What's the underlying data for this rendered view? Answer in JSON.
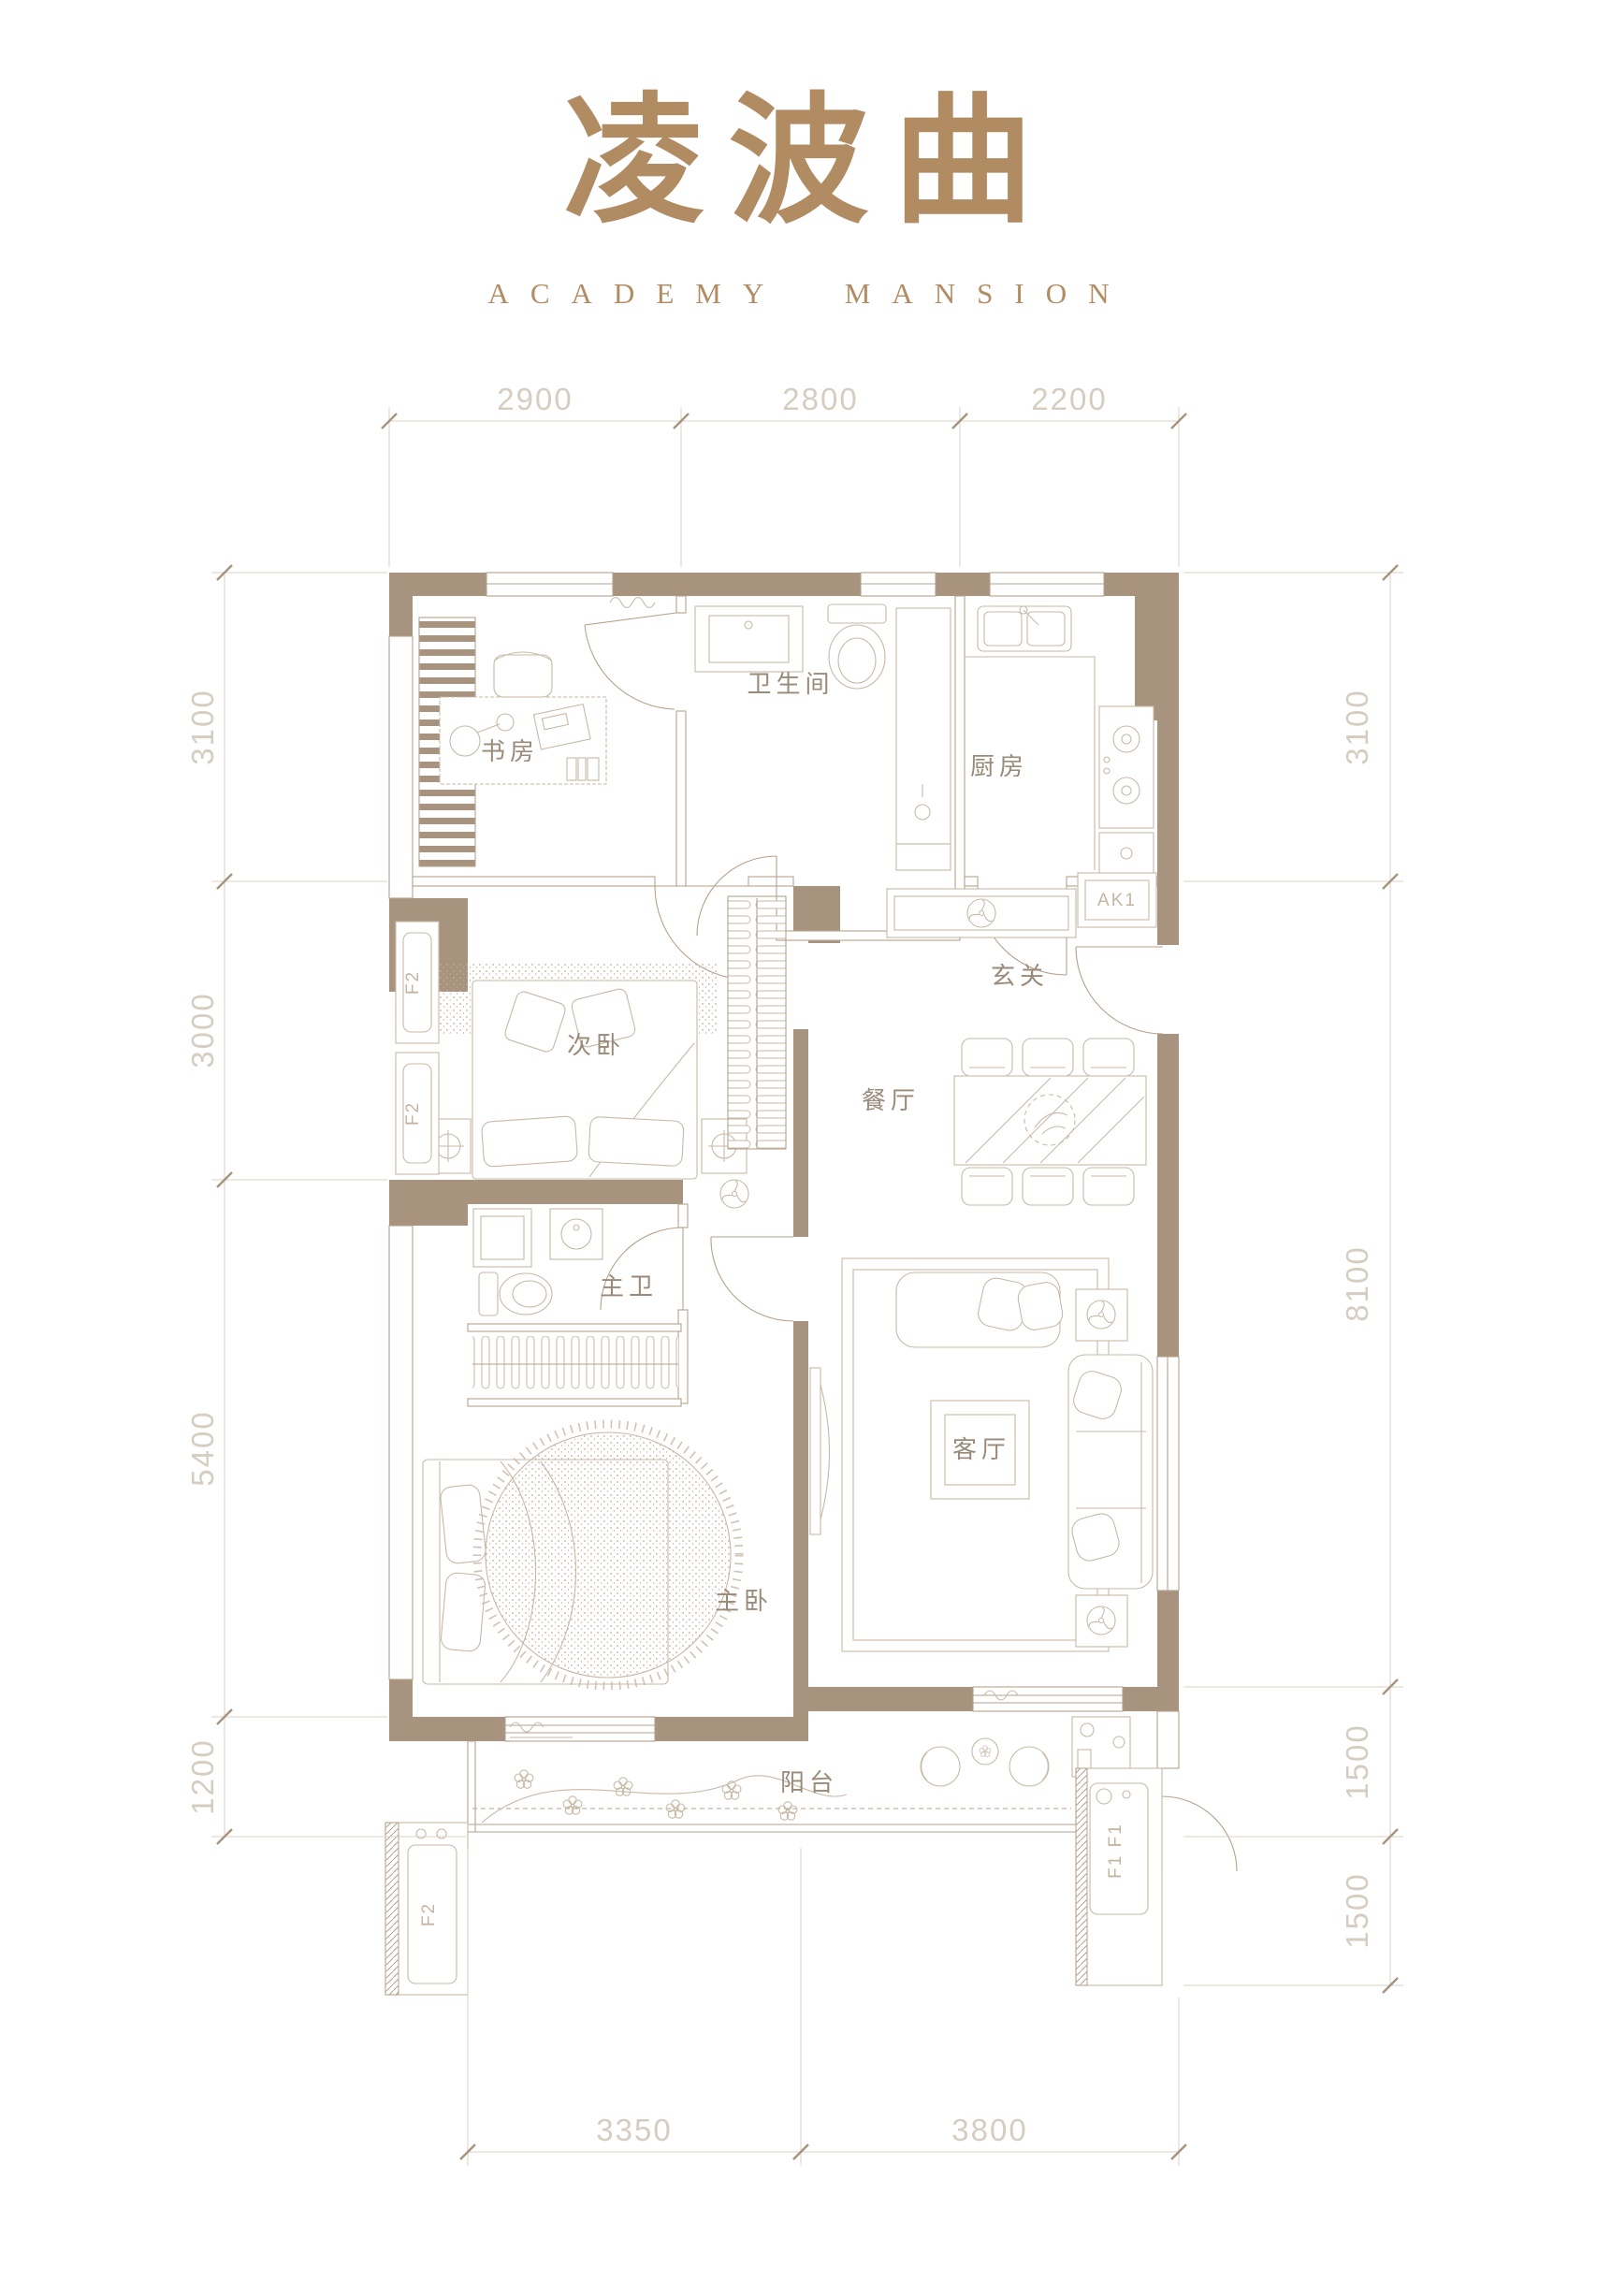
{
  "header": {
    "title": "凌波曲",
    "subtitle": "ACADEMY MANSION"
  },
  "colors": {
    "accent": "#b18c63",
    "wall": "#a8947e",
    "line": "#b5a28c",
    "furniture": "#c8b9a7",
    "dim_text": "#d6cdc1",
    "room_text": "#9a8a79"
  },
  "rooms": {
    "study": {
      "label": "书房"
    },
    "bathroom": {
      "label": "卫生间"
    },
    "kitchen": {
      "label": "厨房"
    },
    "second_bedroom": {
      "label": "次卧"
    },
    "foyer": {
      "label": "玄关"
    },
    "dining": {
      "label": "餐厅"
    },
    "master_bath": {
      "label": "主卫"
    },
    "living": {
      "label": "客厅"
    },
    "master_bedroom": {
      "label": "主卧"
    },
    "balcony": {
      "label": "阳台"
    }
  },
  "equipment": {
    "ak1": "AK1",
    "f2": "F2",
    "f1": "F1 F1"
  },
  "dimensions": {
    "top": [
      "2900",
      "2800",
      "2200"
    ],
    "left": [
      "3100",
      "3000",
      "5400",
      "1200"
    ],
    "right": [
      "3100",
      "8100",
      "1500",
      "1500"
    ],
    "bottom": [
      "3350",
      "3800"
    ]
  }
}
